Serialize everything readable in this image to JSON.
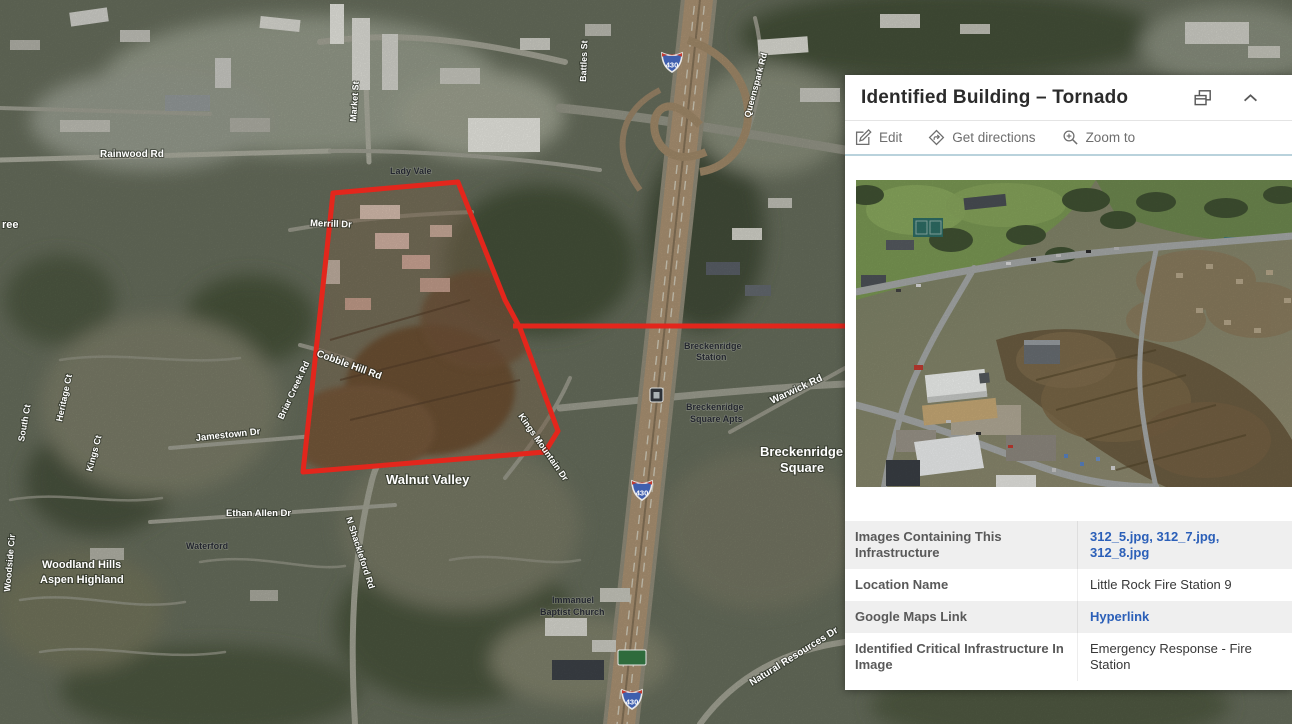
{
  "popup": {
    "title": "Identified Building – Tornado",
    "actions": {
      "edit": "Edit",
      "directions": "Get directions",
      "zoom_to": "Zoom to"
    },
    "table": {
      "rows": [
        {
          "label": "Images Containing This Infrastructure",
          "value": "312_5.jpg, 312_7.jpg, 312_8.jpg",
          "link": true
        },
        {
          "label": "Location Name",
          "value": "Little Rock Fire Station 9",
          "link": false
        },
        {
          "label": "Google Maps Link",
          "value": "Hyperlink",
          "link": true
        },
        {
          "label": "Identified Critical Infrastructure In Image",
          "value": "Emergency Response - Fire Station",
          "link": false
        }
      ]
    }
  },
  "map": {
    "road_labels": [
      {
        "text": "Rainwood Rd",
        "x": 100,
        "y": 157,
        "r": 0,
        "s": 10
      },
      {
        "text": "Market St",
        "x": 356,
        "y": 122,
        "r": -86,
        "s": 9
      },
      {
        "text": "Merrill Dr",
        "x": 310,
        "y": 226,
        "r": 2,
        "s": 9.5
      },
      {
        "text": "Cobble Hill Rd",
        "x": 316,
        "y": 356,
        "r": 20,
        "s": 10
      },
      {
        "text": "Briar Creek Rd",
        "x": 283,
        "y": 420,
        "r": -65,
        "s": 9
      },
      {
        "text": "Heritage Ct",
        "x": 62,
        "y": 422,
        "r": -78,
        "s": 9
      },
      {
        "text": "South Ct",
        "x": 24,
        "y": 442,
        "r": -80,
        "s": 9
      },
      {
        "text": "Jamestown Dr",
        "x": 196,
        "y": 441,
        "r": -6,
        "s": 9.5
      },
      {
        "text": "Kings Mountain Dr",
        "x": 518,
        "y": 416,
        "r": 55,
        "s": 9
      },
      {
        "text": "Walnut Valley",
        "x": 386,
        "y": 484,
        "r": 0,
        "s": 13
      },
      {
        "text": "Ethan Allen Dr",
        "x": 226,
        "y": 516,
        "r": 0,
        "s": 9.5
      },
      {
        "text": "N Shackleford Rd",
        "x": 346,
        "y": 518,
        "r": 72,
        "s": 9
      },
      {
        "text": "Kings Ct",
        "x": 92,
        "y": 472,
        "r": -75,
        "s": 9
      },
      {
        "text": "Woodside Cir",
        "x": 10,
        "y": 592,
        "r": -85,
        "s": 9
      },
      {
        "text": "Woodland Hills",
        "x": 42,
        "y": 568,
        "r": 0,
        "s": 11
      },
      {
        "text": "Aspen Highland",
        "x": 40,
        "y": 583,
        "r": 0,
        "s": 11
      },
      {
        "text": "Queenspark Rd",
        "x": 750,
        "y": 118,
        "r": -75,
        "s": 9
      },
      {
        "text": "Battles St",
        "x": 586,
        "y": 82,
        "r": -88,
        "s": 9
      },
      {
        "text": "Warwick Rd",
        "x": 772,
        "y": 404,
        "r": -25,
        "s": 10
      },
      {
        "text": "Breckenridge",
        "x": 760,
        "y": 456,
        "r": 0,
        "s": 13
      },
      {
        "text": "Square",
        "x": 780,
        "y": 472,
        "r": 0,
        "s": 13
      },
      {
        "text": "Natural Resources Dr",
        "x": 752,
        "y": 686,
        "r": -32,
        "s": 10
      },
      {
        "text": "ree",
        "x": 2,
        "y": 228,
        "r": 0,
        "s": 11
      }
    ],
    "poi_labels": [
      {
        "text": "Lady Vale",
        "x": 390,
        "y": 174
      },
      {
        "text": "Breckenridge",
        "x": 684,
        "y": 349
      },
      {
        "text": "Station",
        "x": 696,
        "y": 360
      },
      {
        "text": "Breckenridge",
        "x": 686,
        "y": 410
      },
      {
        "text": "Square Apts",
        "x": 690,
        "y": 422
      },
      {
        "text": "Immanuel",
        "x": 552,
        "y": 603
      },
      {
        "text": "Baptist Church",
        "x": 540,
        "y": 615
      },
      {
        "text": "Waterford",
        "x": 186,
        "y": 549
      }
    ],
    "shields": [
      {
        "text": "430",
        "x": 672,
        "y": 62
      },
      {
        "text": "430",
        "x": 642,
        "y": 490
      },
      {
        "text": "430",
        "x": 632,
        "y": 699
      }
    ]
  },
  "colors": {
    "alert_red": "#e3261c",
    "link_blue": "#2b5fb8",
    "toolbar_gray": "#6e6e6e"
  }
}
